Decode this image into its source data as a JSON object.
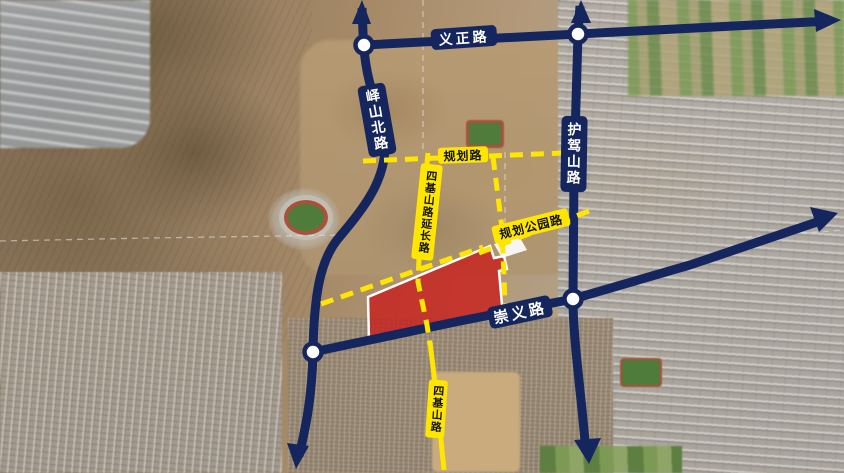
{
  "map_type": "urban-planning-road-map",
  "roads": {
    "yizheng": {
      "label": "义正路"
    },
    "yishanbei": {
      "label": "峄山北路"
    },
    "hujiashan": {
      "label": "护驾山路"
    },
    "chongyi": {
      "label": "崇义路"
    },
    "guihua": {
      "label": "规划路"
    },
    "guihua_gongyuan": {
      "label": "规划公园路"
    },
    "sijishan_ext": {
      "label": "四基山路延长路"
    },
    "sijishan": {
      "label": "四基山路"
    }
  },
  "colors": {
    "trunk_road": "#15265e",
    "trunk_label_text": "#ffffff",
    "planned_road": "#ffe600",
    "planned_label_text": "#111111",
    "site_fill": "#c81e1c",
    "site_outline": "#ffffff",
    "junction_node": "#ffffff",
    "boundary_dash": "#e8e8e8"
  }
}
